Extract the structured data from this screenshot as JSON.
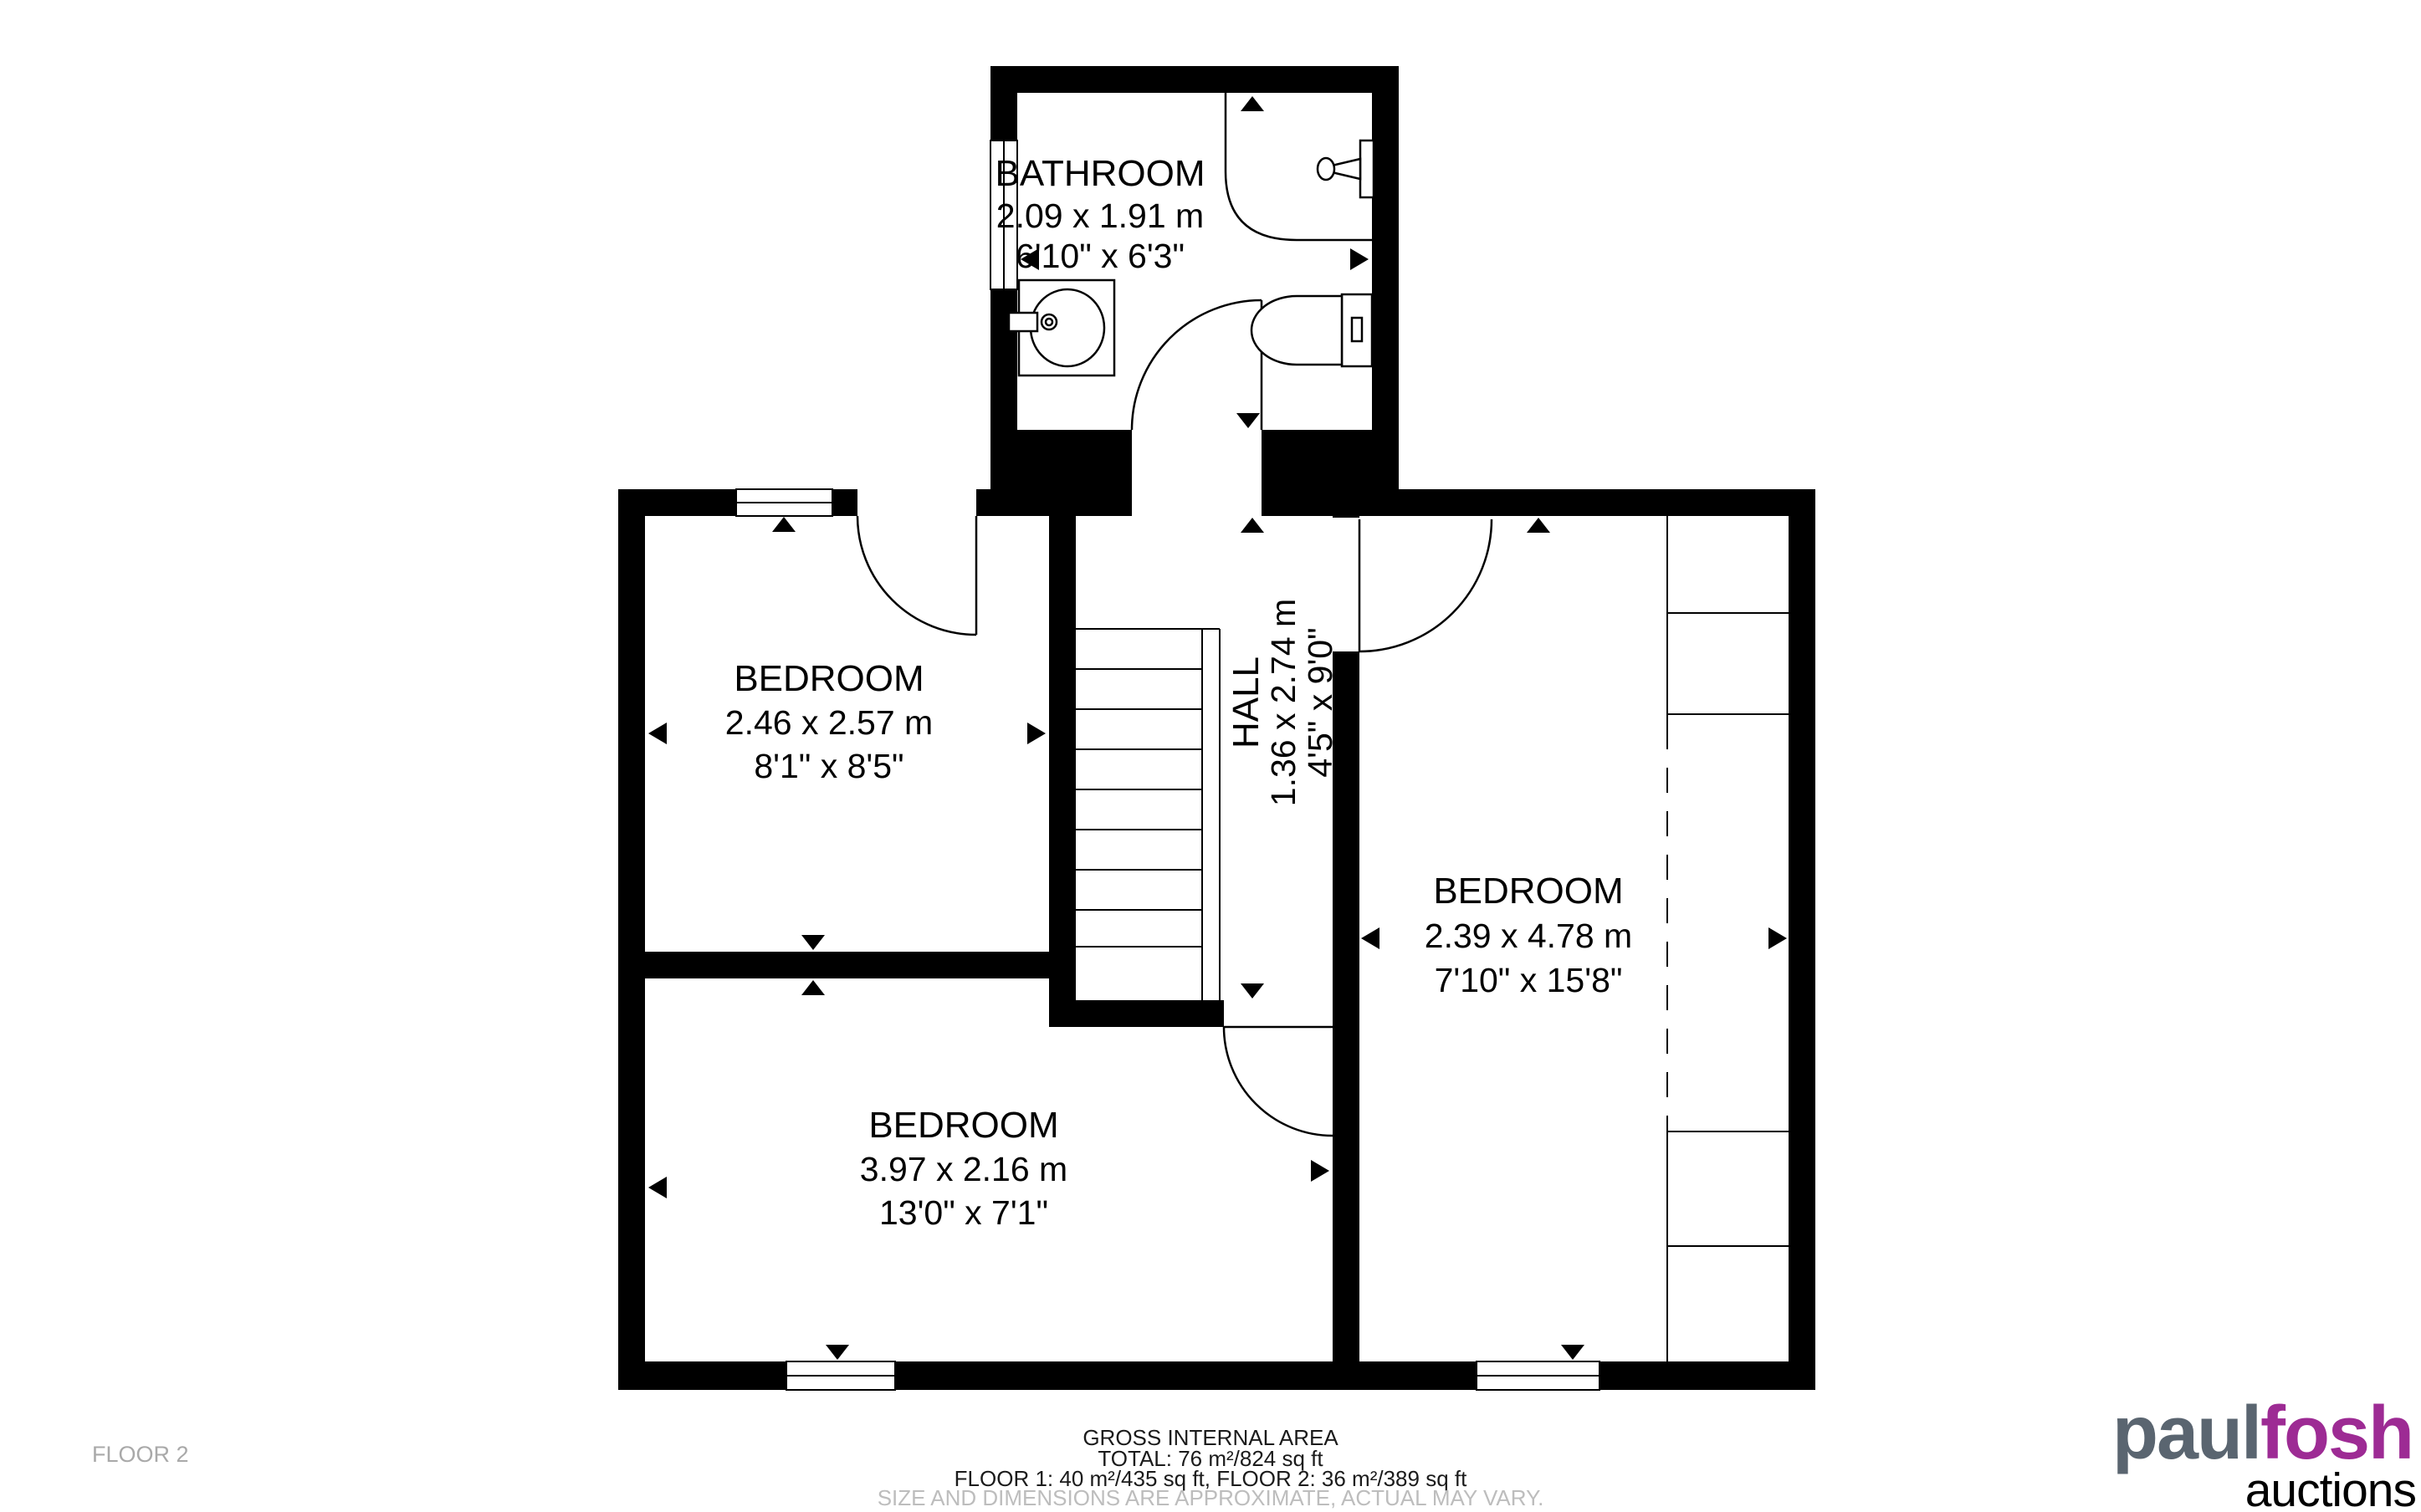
{
  "plan": {
    "rooms": {
      "bathroom": {
        "name": "BATHROOM",
        "metric": "2.09 x 1.91 m",
        "imperial": "6'10\" x 6'3\""
      },
      "bedroom_left": {
        "name": "BEDROOM",
        "metric": "2.46 x 2.57 m",
        "imperial": "8'1\" x 8'5\""
      },
      "hall": {
        "name": "HALL",
        "metric": "1.36 x 2.74 m",
        "imperial": "4'5\" x 9'0\""
      },
      "bedroom_right": {
        "name": "BEDROOM",
        "metric": "2.39 x 4.78 m",
        "imperial": "7'10\" x 15'8\""
      },
      "bedroom_bottom": {
        "name": "BEDROOM",
        "metric": "3.97 x 2.16 m",
        "imperial": "13'0\" x 7'1\""
      }
    },
    "floor_label": "FLOOR 2",
    "footer": {
      "line1": "GROSS INTERNAL AREA",
      "line2": "TOTAL: 76 m²/824 sq ft",
      "line3": "FLOOR 1: 40 m²/435 sq ft, FLOOR 2: 36 m²/389 sq ft",
      "disclaimer": "SIZE AND DIMENSIONS ARE APPROXIMATE, ACTUAL MAY VARY."
    },
    "logo": {
      "part1": "paul",
      "part2": "fosh",
      "part3": "auctions"
    },
    "colors": {
      "logo_gray": "#5a6570",
      "logo_purple": "#9d2b94",
      "wall": "#000000",
      "muted_text": "#a9a9a9",
      "disclaimer_text": "#bdbdbd"
    }
  }
}
